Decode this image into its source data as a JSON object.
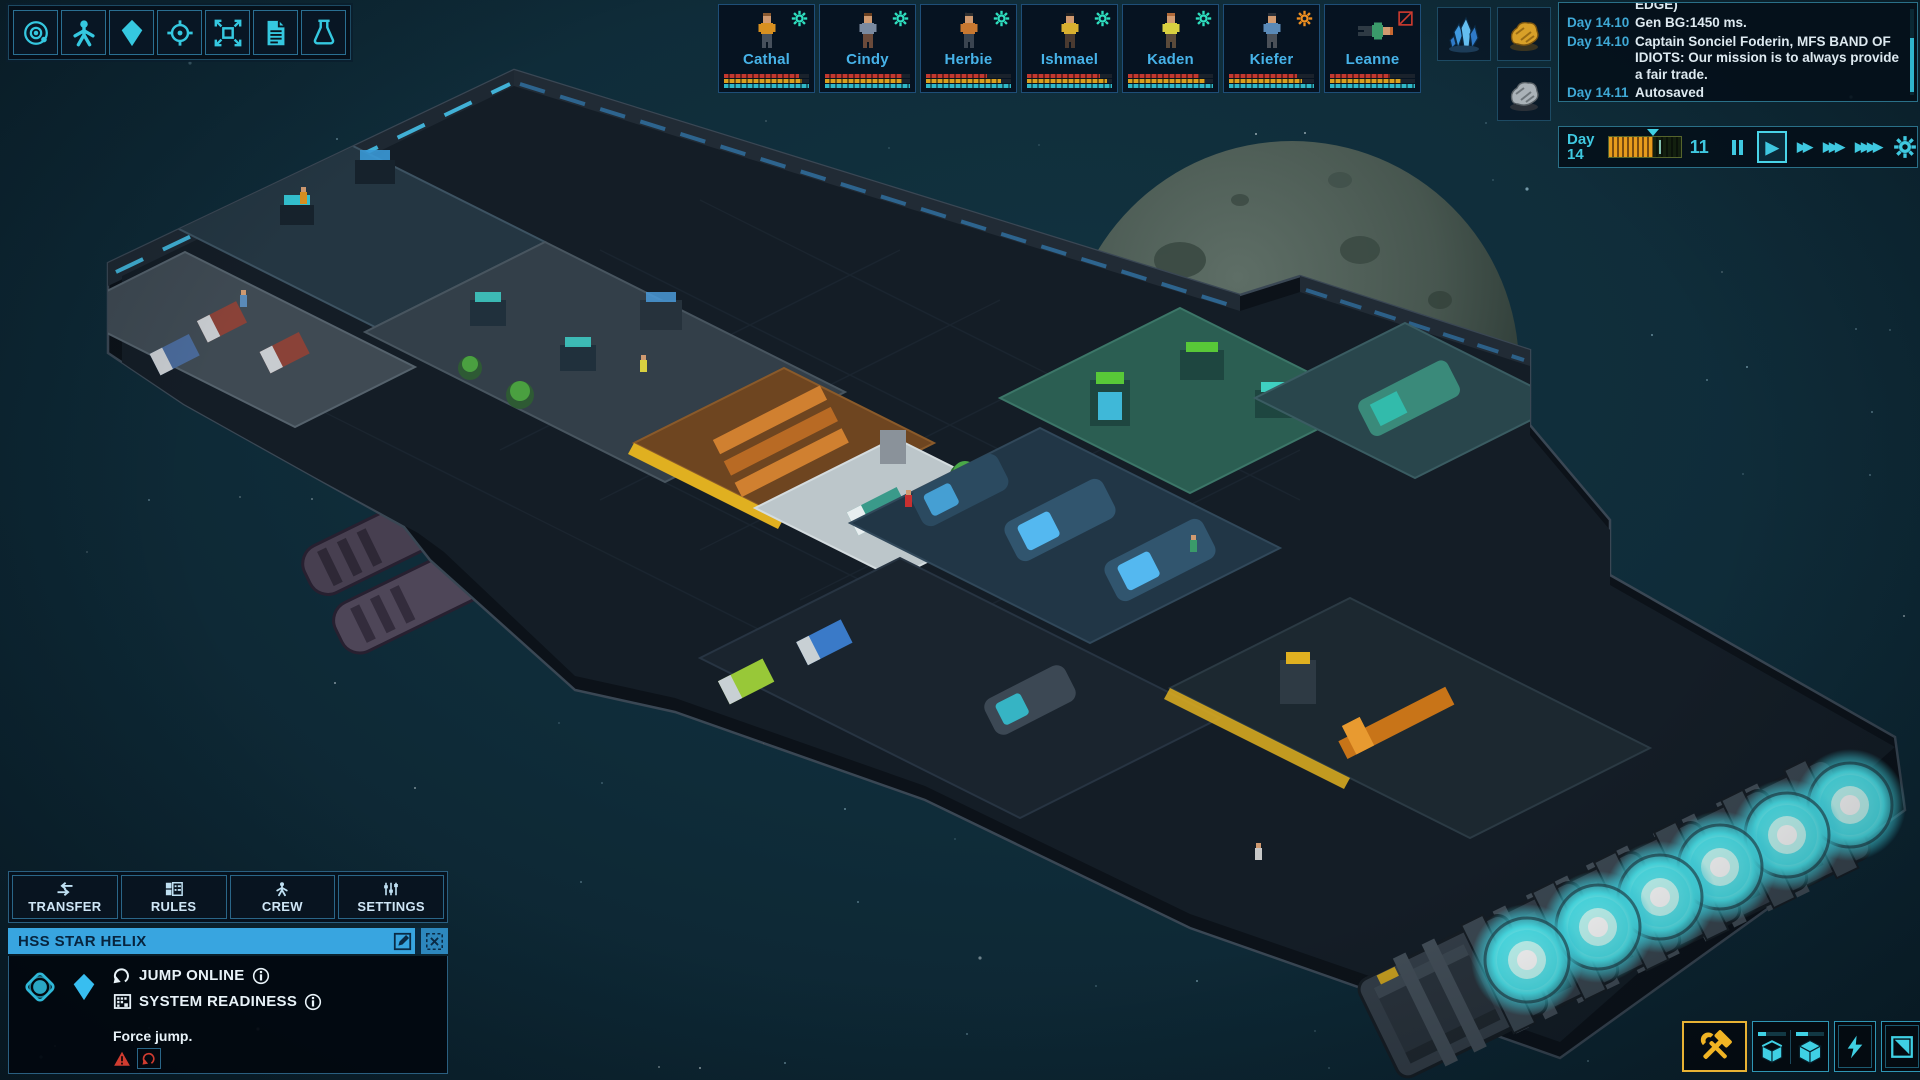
{
  "meta": {
    "game": "space-ship-colony-sim",
    "scene": "isometric-spaceship-with-moon"
  },
  "palette": {
    "space_bg": "#0f2c39",
    "accent_cyan": "#3fc8e0",
    "panel_border": "#2a7088",
    "panel_bg": "#04101a",
    "crew_name": "#46b2e8",
    "title_bar_blue": "#38a5e0",
    "warning_red": "#d03c30",
    "build_highlight": "#e8b234",
    "engine_glow": "#4ae4ec",
    "log_day": "#3fa9d6",
    "log_text": "#dde9f0"
  },
  "toolbar": {
    "icons": [
      {
        "name": "system-view-icon",
        "sym": "orbit"
      },
      {
        "name": "crew-icon",
        "sym": "person"
      },
      {
        "name": "ship-icon",
        "sym": "kite"
      },
      {
        "name": "target-icon",
        "sym": "crosshair"
      },
      {
        "name": "expand-view-icon",
        "sym": "expand"
      },
      {
        "name": "reports-icon",
        "sym": "doc"
      },
      {
        "name": "research-icon",
        "sym": "flask"
      }
    ]
  },
  "crew_bar": {
    "bar_colors": [
      "#c23830",
      "#d8a020",
      "#2fb8c8"
    ],
    "members": [
      {
        "name": "Cathal",
        "status": "gear",
        "status_color": "#2fe0c0",
        "shirt": "#d89020",
        "pants": "#46505c",
        "hair": "#8a5a30",
        "pose": "standing",
        "bars": [
          88,
          92,
          100
        ]
      },
      {
        "name": "Cindy",
        "status": "gear",
        "status_color": "#2fe0c0",
        "shirt": "#7a8aa0",
        "pants": "#6a4a3a",
        "hair": "#6a4020",
        "pose": "standing",
        "bars": [
          90,
          90,
          100
        ]
      },
      {
        "name": "Herbie",
        "status": "gear",
        "status_color": "#2fe0c0",
        "shirt": "#c87830",
        "pants": "#3a4450",
        "hair": "#303030",
        "pose": "standing",
        "bars": [
          72,
          88,
          100
        ]
      },
      {
        "name": "Ishmael",
        "status": "gear",
        "status_color": "#2fe0c0",
        "shirt": "#d8b030",
        "pants": "#4a3a30",
        "hair": "#202020",
        "pose": "standing",
        "bars": [
          86,
          94,
          100
        ]
      },
      {
        "name": "Kaden",
        "status": "gear",
        "status_color": "#2fe0c0",
        "shirt": "#d8d040",
        "pants": "#5a4a3a",
        "hair": "#b06a3a",
        "pose": "standing",
        "bars": [
          84,
          90,
          100
        ]
      },
      {
        "name": "Kiefer",
        "status": "gear",
        "status_color": "#f09020",
        "shirt": "#5a8ab8",
        "pants": "#4a5058",
        "hair": "#2a3038",
        "pose": "standing",
        "bars": [
          80,
          86,
          100
        ]
      },
      {
        "name": "Leanne",
        "status": "forbidden",
        "status_color": "#d03c30",
        "shirt": "#3a9a6a",
        "pants": "#2e3a44",
        "hair": "#c86830",
        "pose": "lying",
        "bars": [
          70,
          84,
          100
        ]
      }
    ]
  },
  "resources": {
    "items": [
      {
        "name": "crystal-resource-icon",
        "sym": "crystal",
        "col": 0,
        "row": 0
      },
      {
        "name": "gold-ore-resource-icon",
        "sym": "gold",
        "col": 1,
        "row": 0
      },
      {
        "name": "rock-ore-resource-icon",
        "sym": "rock",
        "col": 1,
        "row": 1
      }
    ]
  },
  "event_log": {
    "entries": [
      {
        "day": "",
        "text": "EDGE)",
        "partial": true
      },
      {
        "day": "Day 14.10",
        "text": "Gen BG:1450 ms."
      },
      {
        "day": "Day 14.10",
        "text": "Captain Sonciel Foderin, MFS BAND OF IDIOTS:  Our mission is to always provide a fair trade."
      },
      {
        "day": "Day 14.11",
        "text": "Autosaved"
      }
    ]
  },
  "time_controls": {
    "day_label": "Day",
    "day_number": "14",
    "hour": "11",
    "progress_pct": 62,
    "play_symbol": "▶",
    "ff2": "▶▶",
    "ff3": "▶▶▶",
    "ff4": "▶▶▶▶"
  },
  "ship_panel": {
    "tabs": [
      {
        "label": "TRANSFER",
        "sym": "transfer"
      },
      {
        "label": "RULES",
        "sym": "rules"
      },
      {
        "label": "CREW",
        "sym": "person"
      },
      {
        "label": "SETTINGS",
        "sym": "sliders"
      }
    ],
    "ship_name": "HSS STAR HELIX",
    "rows": [
      {
        "label": "JUMP ONLINE"
      },
      {
        "label": "SYSTEM READINESS"
      }
    ],
    "force_jump_label": "Force jump."
  },
  "build_toolbar": {
    "buttons": [
      "build-tools",
      "storage-open-box",
      "storage-cube",
      "power",
      "floor-plan"
    ],
    "mini_bars": [
      30,
      45
    ]
  }
}
